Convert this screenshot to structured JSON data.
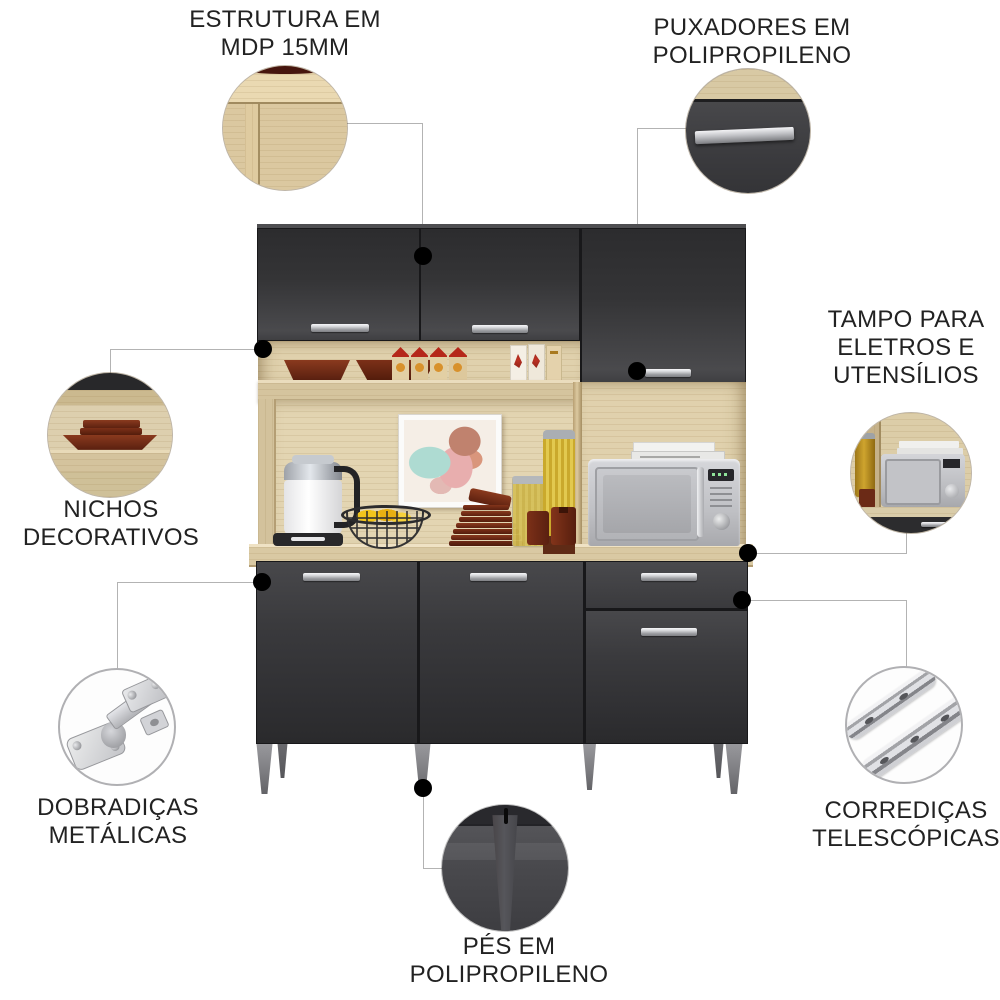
{
  "callouts": {
    "estrutura": {
      "lines": [
        "ESTRUTURA EM",
        "MDP 15MM"
      ]
    },
    "puxadores": {
      "lines": [
        "PUXADORES EM",
        "POLIPROPILENO"
      ]
    },
    "tampo": {
      "lines": [
        "TAMPO PARA",
        "ELETROS E",
        "UTENSÍLIOS"
      ]
    },
    "nichos": {
      "lines": [
        "NICHOS",
        "DECORATIVOS"
      ]
    },
    "dobradicas": {
      "lines": [
        "DOBRADIÇAS",
        "METÁLICAS"
      ]
    },
    "corredicas": {
      "lines": [
        "CORREDIÇAS",
        "TELESCÓPICAS"
      ]
    },
    "pes": {
      "lines": [
        "PÉS EM",
        "POLIPROPILENO"
      ]
    }
  },
  "colors": {
    "background": "#ffffff",
    "text": "#222222",
    "leader_line": "#b3b3b3",
    "connector_dot": "#000000",
    "door_dark": "#38383a",
    "wood_light": "#e0d1ad",
    "countertop": "#d9c9a3",
    "handle_silver": "#c6c7cb",
    "leg_gray": "#88888c",
    "tray_brown": "#6b2a16",
    "accent_red": "#b5271a"
  }
}
